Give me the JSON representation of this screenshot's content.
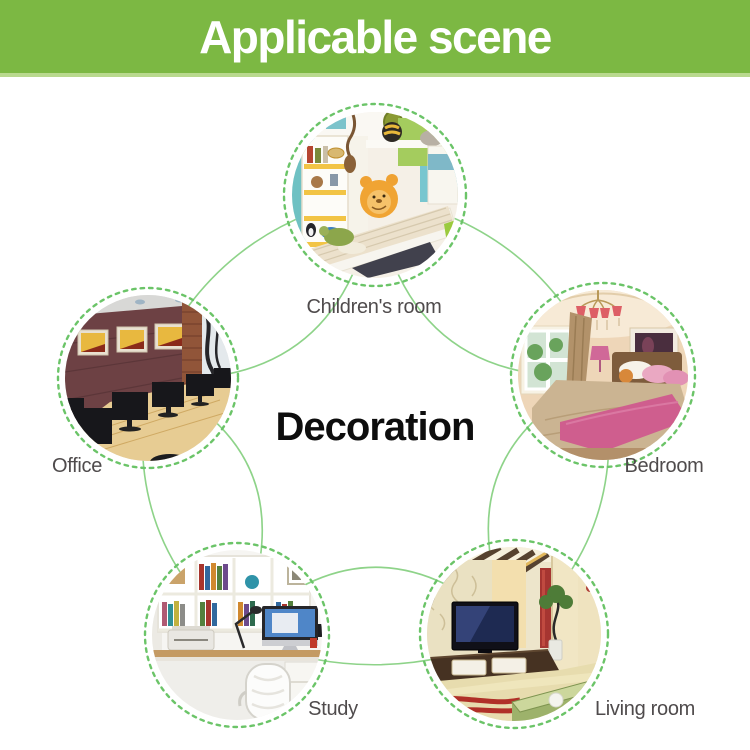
{
  "header": {
    "title": "Applicable scene"
  },
  "diagram": {
    "center_label": "Decoration",
    "nodes": [
      {
        "id": "children-room",
        "label": "Children's room",
        "photo": "children-room-photo"
      },
      {
        "id": "office",
        "label": "Office",
        "photo": "office-photo"
      },
      {
        "id": "bedroom",
        "label": "Bedroom",
        "photo": "bedroom-photo"
      },
      {
        "id": "study",
        "label": "Study",
        "photo": "study-photo"
      },
      {
        "id": "living-room",
        "label": "Living room",
        "photo": "living-room-photo"
      }
    ]
  },
  "colors": {
    "header_bg": "#7cb843",
    "header_edge": "#b9d98e",
    "header_text": "#ffffff",
    "ring_green": "#6bc468",
    "arc_green": "#8ed389",
    "label_text": "#4f4b4c",
    "center_text": "#0d0d0d",
    "page_bg": "#ffffff"
  }
}
